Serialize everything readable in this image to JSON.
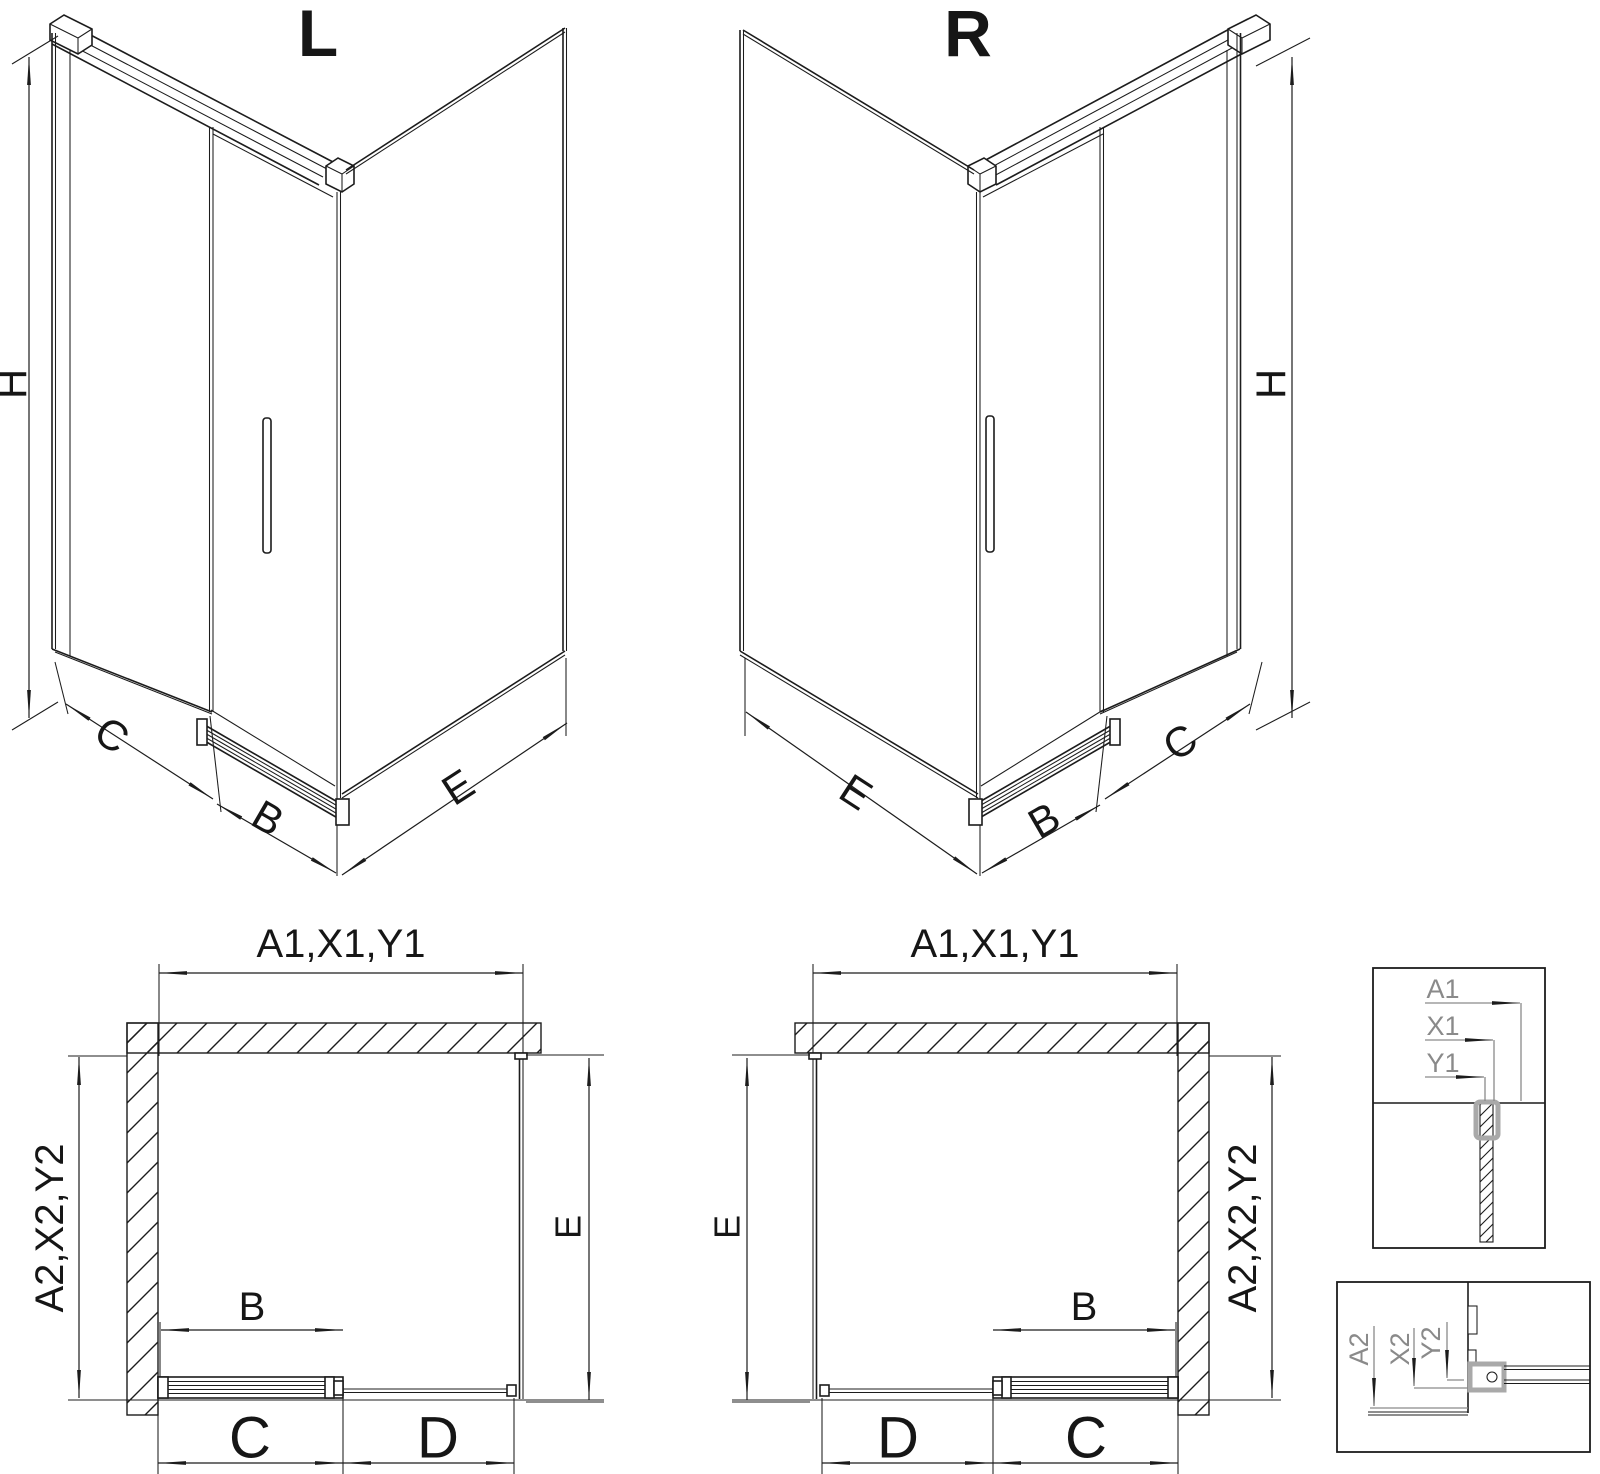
{
  "drawing": {
    "type": "shower-enclosure-technical-drawing",
    "colors": {
      "line": "#1c1c1c",
      "dim_gray": "#8a8a8a",
      "accent_gray": "#a9a9a9",
      "background": "#ffffff"
    }
  },
  "iso_left": {
    "title": "L",
    "h": "H",
    "c": "C",
    "b": "B",
    "e": "E"
  },
  "iso_right": {
    "title": "R",
    "h": "H",
    "c": "C",
    "b": "B",
    "e": "E"
  },
  "plan_left": {
    "width_top": "A1,X1,Y1",
    "depth_side": "A2,X2,Y2",
    "b": "B",
    "c": "C",
    "d": "D",
    "e": "E"
  },
  "plan_right": {
    "width_top": "A1,X1,Y1",
    "depth_side": "A2,X2,Y2",
    "b": "B",
    "c": "C",
    "d": "D",
    "e": "E"
  },
  "detail_top": {
    "a1": "A1",
    "x1": "X1",
    "y1": "Y1"
  },
  "detail_bottom": {
    "a2": "A2",
    "x2": "X2",
    "y2": "Y2"
  }
}
